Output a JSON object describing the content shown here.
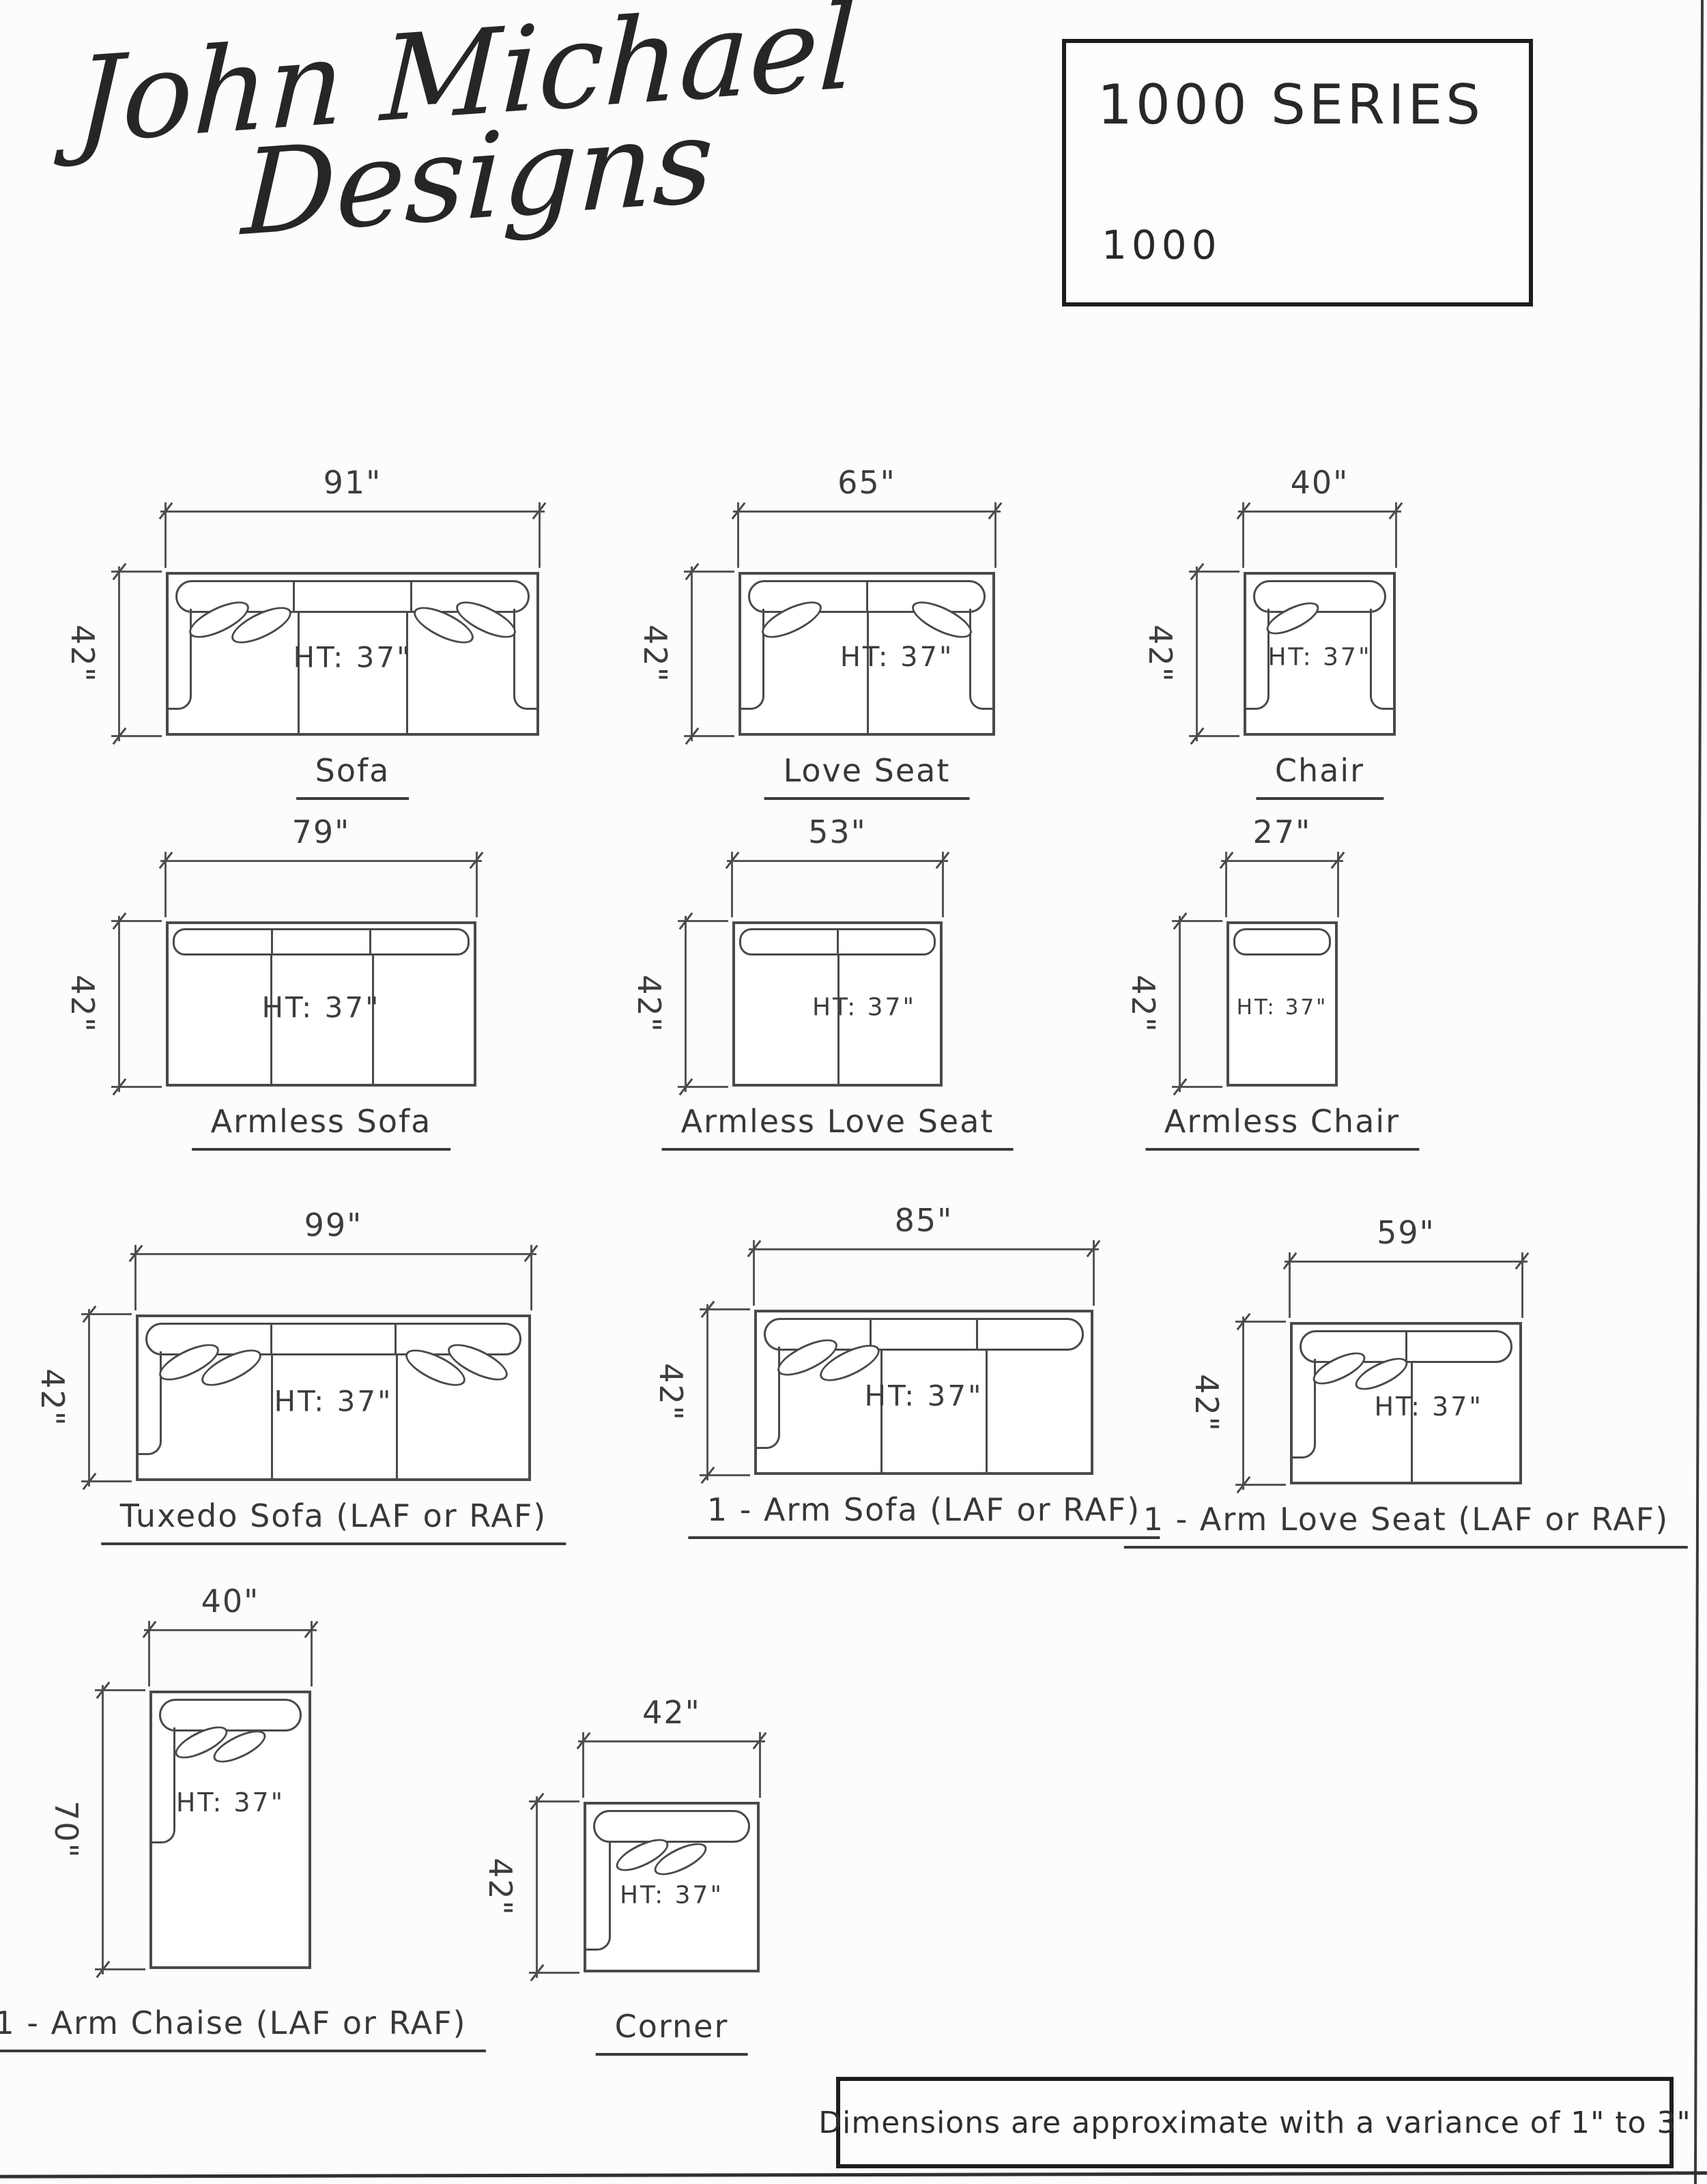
{
  "logo": {
    "line1": "John Michael",
    "line2": "Designs"
  },
  "series_box": {
    "title": "1000 SERIES",
    "model": "1000"
  },
  "footer": {
    "note": "Dimensions are approximate with a variance of 1\" to 3\""
  },
  "colors": {
    "line": "#4a4a4a",
    "text": "#3d3d3d",
    "box_border": "#1d1d1d",
    "paper": "#fcfcfc"
  },
  "diagrams": [
    {
      "name": "Sofa",
      "width_label": "91\"",
      "depth_label": "42\"",
      "ht_label": "HT: 37\""
    },
    {
      "name": "Love Seat",
      "width_label": "65\"",
      "depth_label": "42\"",
      "ht_label": "HT: 37\""
    },
    {
      "name": "Chair",
      "width_label": "40\"",
      "depth_label": "42\"",
      "ht_label": "HT: 37\""
    },
    {
      "name": "Armless Sofa",
      "width_label": "79\"",
      "depth_label": "42\"",
      "ht_label": "HT: 37\""
    },
    {
      "name": "Armless Love Seat",
      "width_label": "53\"",
      "depth_label": "42\"",
      "ht_label": "HT: 37\""
    },
    {
      "name": "Armless Chair",
      "width_label": "27\"",
      "depth_label": "42\"",
      "ht_label": "HT: 37\""
    },
    {
      "name": "Tuxedo Sofa (LAF or RAF)",
      "width_label": "99\"",
      "depth_label": "42\"",
      "ht_label": "HT: 37\""
    },
    {
      "name": "1 - Arm Sofa (LAF or RAF)",
      "width_label": "85\"",
      "depth_label": "42\"",
      "ht_label": "HT: 37\""
    },
    {
      "name": "1 - Arm Love Seat (LAF or RAF)",
      "width_label": "59\"",
      "depth_label": "42\"",
      "ht_label": "HT: 37\""
    },
    {
      "name": "1 - Arm Chaise (LAF or RAF)",
      "width_label": "40\"",
      "depth_label": "70\"",
      "ht_label": "HT: 37\""
    },
    {
      "name": "Corner",
      "width_label": "42\"",
      "depth_label": "42\"",
      "ht_label": "HT: 37\""
    }
  ]
}
